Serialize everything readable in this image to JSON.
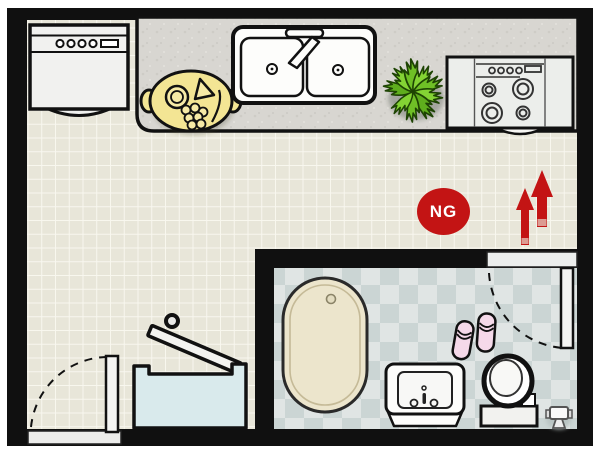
{
  "floor_plan": {
    "type": "apartment-floor-plan",
    "badge": {
      "label": "NG",
      "bg_color": "#c31414",
      "text_color": "#ffffff"
    },
    "arrows": {
      "direction": "up",
      "count": 2,
      "color": "#c31414"
    },
    "kitchen": {
      "fixtures": [
        "dishwasher",
        "serving-platter",
        "double-sink",
        "faucet",
        "houseplant",
        "gas-stove",
        "kitchen-counter"
      ]
    },
    "bathroom": {
      "fixtures": [
        "bathtub",
        "slippers",
        "vanity-sink",
        "toilet",
        "toilet-paper-stand",
        "bathroom-door-swing"
      ]
    },
    "hall": {
      "fixtures": [
        "entry-door-swing",
        "laundry-chest-open-lid"
      ]
    },
    "colors": {
      "wall": "#101010",
      "kitchen_tile": "#e8e6d9",
      "kitchen_grout": "#f8f7ef",
      "counter": "#d8d6d1",
      "bath_tile_light": "#e0e5e4",
      "bath_tile_dark": "#cbd5d4",
      "accent_red": "#c31414",
      "bathtub": "#ece5cc",
      "chest_blue": "#d9eaec",
      "platter_yellow": "#f3e594",
      "plant_green": "#76c629",
      "slipper_pink": "#f5d9e9"
    }
  }
}
